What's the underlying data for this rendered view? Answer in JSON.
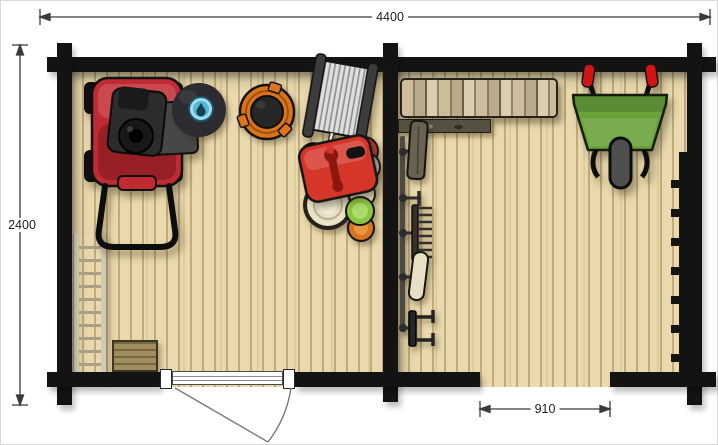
{
  "title": "Garden shed floor plan (top view)",
  "dimensions": {
    "width": "4400",
    "depth": "2400",
    "side_opening": "910"
  },
  "colors": {
    "wall": "#131313",
    "floor": "#e9d9ad",
    "plank_line": "#c1aa7c",
    "mower_red": "#c02a31",
    "engine_gray": "#2c2c2c",
    "bag_gray": "#474747",
    "water_tank_black": "#2b2b30",
    "water_blue": "#9fdcef",
    "bucket_orange": "#dd7419",
    "toolbox_red": "#d6362a",
    "can_red": "#c0392b",
    "can_silver": "#bdbdbd",
    "can_cream": "#eae2c8",
    "can_green": "#8cc63f",
    "can_orange": "#d8741f",
    "wheelbarrow_green": "#6aa33a",
    "grip_red": "#d41414",
    "mat_brown": "#a08e5e",
    "ladder_beige": "#d3cbb1",
    "dim_line": "#3a3a3a"
  },
  "rooms": [
    {
      "name": "left-room"
    },
    {
      "name": "right-room"
    }
  ],
  "items": [
    "lawn-mower",
    "water-tank",
    "hose-bucket",
    "hose-reel-cart",
    "spare-tire",
    "toolbox",
    "paint-can-large",
    "paint-cans-stack",
    "ladder",
    "doormat",
    "entrance-door",
    "firewood-stack",
    "wooden-plank-shelf",
    "garden-tool-rack",
    "spade",
    "hand-hook",
    "garden-rake",
    "hoe-blade",
    "cultivator",
    "wheelbarrow",
    "wall-bracket-rack",
    "side-opening"
  ]
}
